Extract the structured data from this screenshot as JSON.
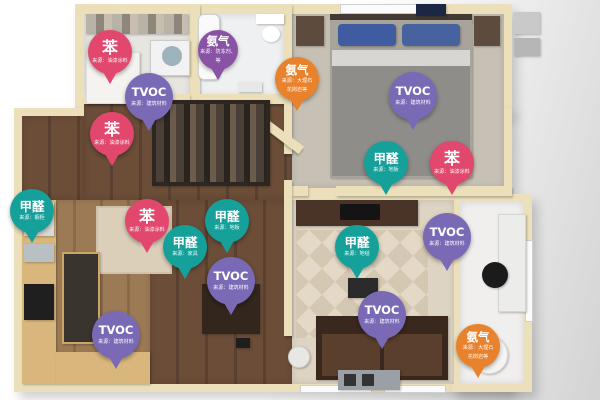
{
  "scene": {
    "description": "3D apartment floor plan with indoor air pollutant source markers",
    "pollutant_types": {
      "benzene": {
        "label": "苯",
        "color": "#e2476e"
      },
      "tvoc": {
        "label": "TVOC",
        "color": "#7a6ab6"
      },
      "formaldehyde": {
        "label": "甲醛",
        "color": "#16a09a"
      },
      "ammonia-purple": {
        "label": "氨气",
        "color": "#8a52a5"
      },
      "ammonia-orange": {
        "label": "氨气",
        "color": "#e8822c"
      }
    }
  },
  "pins": [
    {
      "id": "pin-benzene-1",
      "type": "benzene",
      "label": "苯",
      "sub": [
        "来源：油漆涂料"
      ],
      "x": 110,
      "y": 52
    },
    {
      "id": "pin-ammonia-1",
      "type": "ammonia-purple",
      "label": "氨气",
      "sub": [
        "来源：防冻剂、",
        "等"
      ],
      "x": 218,
      "y": 50
    },
    {
      "id": "pin-ammonia-2",
      "type": "ammonia-orange",
      "label": "氨气",
      "sub": [
        "来源：大理石",
        "花岗岩等"
      ],
      "x": 297,
      "y": 79
    },
    {
      "id": "pin-tvoc-1",
      "type": "tvoc",
      "label": "TVOC",
      "sub": [
        "来源：建筑材料"
      ],
      "x": 149,
      "y": 97
    },
    {
      "id": "pin-benzene-2",
      "type": "benzene",
      "label": "苯",
      "sub": [
        "来源：油漆涂料"
      ],
      "x": 112,
      "y": 134
    },
    {
      "id": "pin-tvoc-2",
      "type": "tvoc",
      "label": "TVOC",
      "sub": [
        "来源：建筑材料"
      ],
      "x": 413,
      "y": 96
    },
    {
      "id": "pin-formaldehyde-1",
      "type": "formaldehyde",
      "label": "甲醛",
      "sub": [
        "来源：地板"
      ],
      "x": 386,
      "y": 163
    },
    {
      "id": "pin-benzene-3",
      "type": "benzene",
      "label": "苯",
      "sub": [
        "来源：油漆涂料"
      ],
      "x": 452,
      "y": 163
    },
    {
      "id": "pin-formaldehyde-2",
      "type": "formaldehyde",
      "label": "甲醛",
      "sub": [
        "来源：橱柜"
      ],
      "x": 32,
      "y": 211
    },
    {
      "id": "pin-benzene-4",
      "type": "benzene",
      "label": "苯",
      "sub": [
        "来源：油漆涂料"
      ],
      "x": 147,
      "y": 221
    },
    {
      "id": "pin-formaldehyde-3",
      "type": "formaldehyde",
      "label": "甲醛",
      "sub": [
        "来源：家具"
      ],
      "x": 185,
      "y": 247
    },
    {
      "id": "pin-formaldehyde-4",
      "type": "formaldehyde",
      "label": "甲醛",
      "sub": [
        "来源：地板"
      ],
      "x": 227,
      "y": 221
    },
    {
      "id": "pin-tvoc-3",
      "type": "tvoc",
      "label": "TVOC",
      "sub": [
        "来源：建筑材料"
      ],
      "x": 231,
      "y": 281
    },
    {
      "id": "pin-formaldehyde-5",
      "type": "formaldehyde",
      "label": "甲醛",
      "sub": [
        "来源：地毯"
      ],
      "x": 357,
      "y": 247
    },
    {
      "id": "pin-tvoc-4",
      "type": "tvoc",
      "label": "TVOC",
      "sub": [
        "来源：建筑材料"
      ],
      "x": 447,
      "y": 237
    },
    {
      "id": "pin-tvoc-5",
      "type": "tvoc",
      "label": "TVOC",
      "sub": [
        "来源：建筑材料"
      ],
      "x": 116,
      "y": 335
    },
    {
      "id": "pin-tvoc-6",
      "type": "tvoc",
      "label": "TVOC",
      "sub": [
        "来源：建筑材料"
      ],
      "x": 382,
      "y": 315
    },
    {
      "id": "pin-ammonia-3",
      "type": "ammonia-orange",
      "label": "氨气",
      "sub": [
        "来源：大理石",
        "花岗岩等"
      ],
      "x": 478,
      "y": 346
    }
  ]
}
